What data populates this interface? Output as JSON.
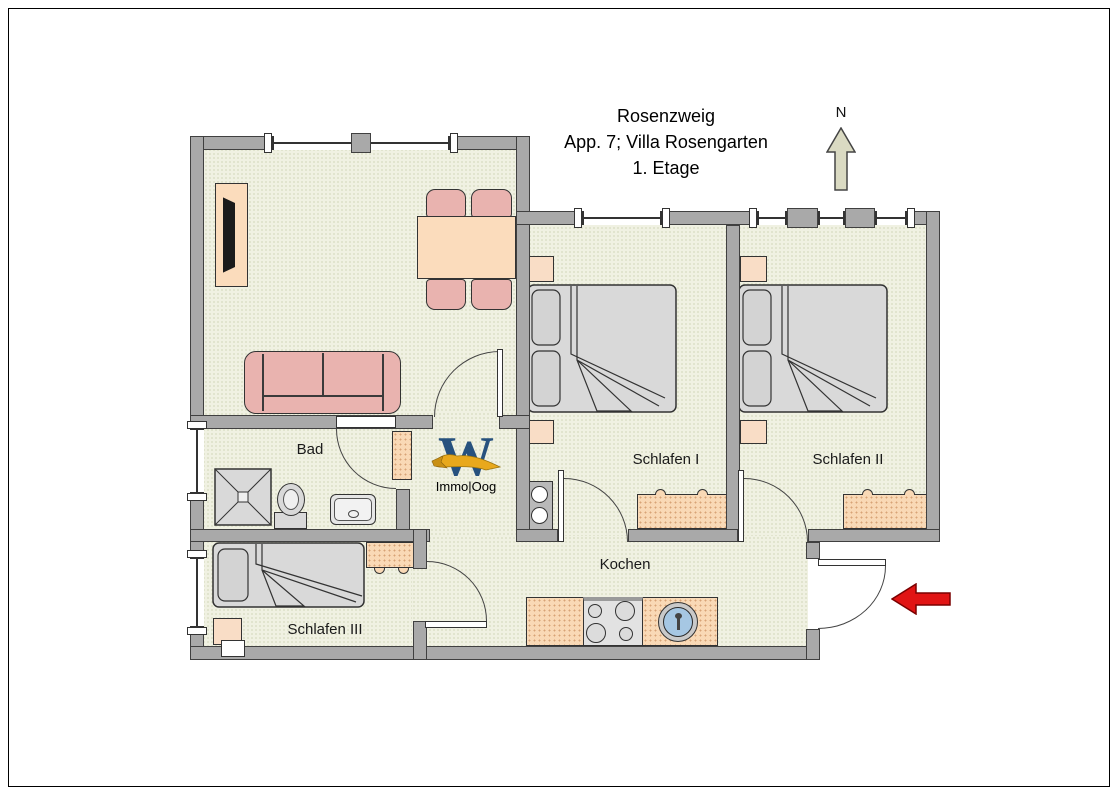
{
  "title": {
    "line1": "Rosenzweig",
    "line2": "App. 7; Villa Rosengarten",
    "line3": "1. Etage"
  },
  "compass": {
    "label": "N"
  },
  "logo": {
    "letter": "W",
    "text": "Immo|Oog"
  },
  "rooms": {
    "bad": "Bad",
    "schlafen1": "Schlafen I",
    "schlafen2": "Schlafen II",
    "schlafen3": "Schlafen III",
    "kochen": "Kochen"
  },
  "colors": {
    "wall": "#a9a9a9",
    "floor": "#f0f1e2",
    "furniture_peach": "#fbdcbc",
    "furniture_pink": "#e9b3af",
    "bed_gray": "#d9d9d9",
    "kitchen_sink_blue": "#a6c7e3",
    "entrance_arrow_red": "#e11414",
    "north_arrow_beige": "#dadac2",
    "logo_blue": "#27517e",
    "logo_gold": "#e8a81c"
  }
}
